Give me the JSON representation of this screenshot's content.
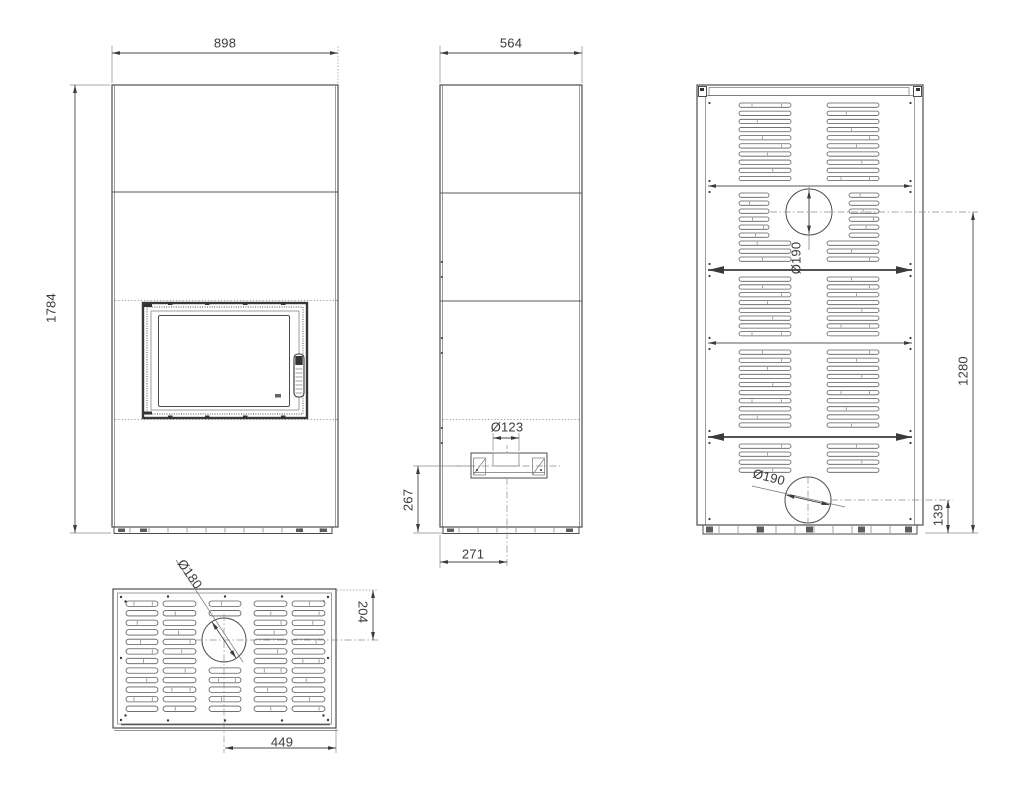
{
  "drawing": {
    "type": "technical-dimension-drawing",
    "subject": "fireplace-stove-unit",
    "colors": {
      "line": "#4d4d4d",
      "dark": "#333333",
      "light": "#8a8a8a",
      "text": "#3a3a3a",
      "background": "#ffffff"
    },
    "views": {
      "front": {
        "dims": {
          "width": "898",
          "height": "1784"
        }
      },
      "side": {
        "dims": {
          "depth": "564",
          "intake_diameter": "Ø123",
          "intake_center_height": "267",
          "intake_center_offset": "271"
        }
      },
      "back": {
        "dims": {
          "upper_flue_diameter": "Ø190",
          "upper_flue_center_height": "1280",
          "lower_flue_diameter": "Ø190",
          "lower_flue_center_height": "139"
        }
      },
      "top": {
        "dims": {
          "flue_diameter": "Ø180",
          "flue_center_from_rear": "204",
          "flue_center_from_side": "449"
        }
      }
    }
  }
}
